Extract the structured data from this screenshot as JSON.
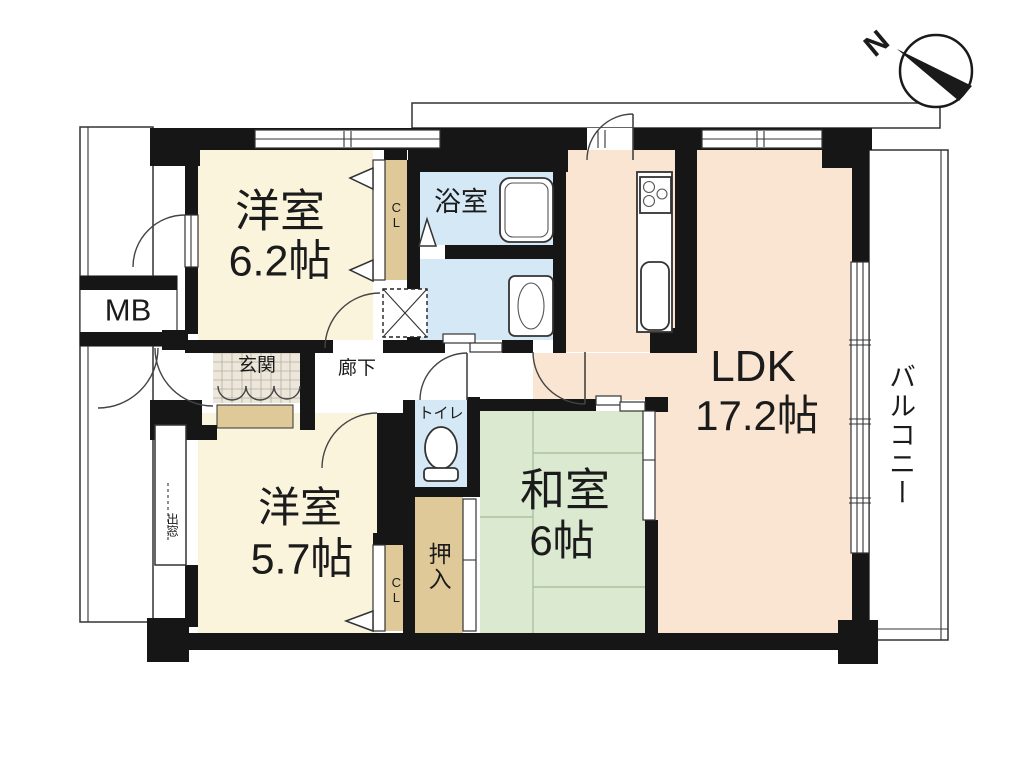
{
  "compass": {
    "north_label": "N"
  },
  "rooms": {
    "western_room_1": {
      "name": "洋室",
      "size": "6.2帖"
    },
    "western_room_2": {
      "name": "洋室",
      "size": "5.7帖"
    },
    "japanese_room": {
      "name": "和室",
      "size": "6帖"
    },
    "ldk": {
      "name": "LDK",
      "size": "17.2帖"
    },
    "bathroom": {
      "name": "浴室"
    },
    "toilet": {
      "name": "トイレ"
    },
    "entrance": {
      "name": "玄関"
    },
    "hallway": {
      "name": "廊下"
    },
    "closet_upper": {
      "name": "CL"
    },
    "closet_lower": {
      "name": "CL"
    },
    "futon_closet": {
      "name": "押入"
    },
    "balcony": {
      "name": "バルコニー"
    },
    "meter_box": {
      "name": "MB"
    },
    "bay_window": {
      "name": "出窓"
    }
  },
  "colors": {
    "wall": "#161616",
    "western_room": "#faf4dd",
    "ldk": "#fae5d2",
    "japanese_room": "#dbe9d1",
    "wet_area": "#d5e8f6",
    "closet": "#dfc998",
    "entrance_tile": "#ece7da"
  }
}
